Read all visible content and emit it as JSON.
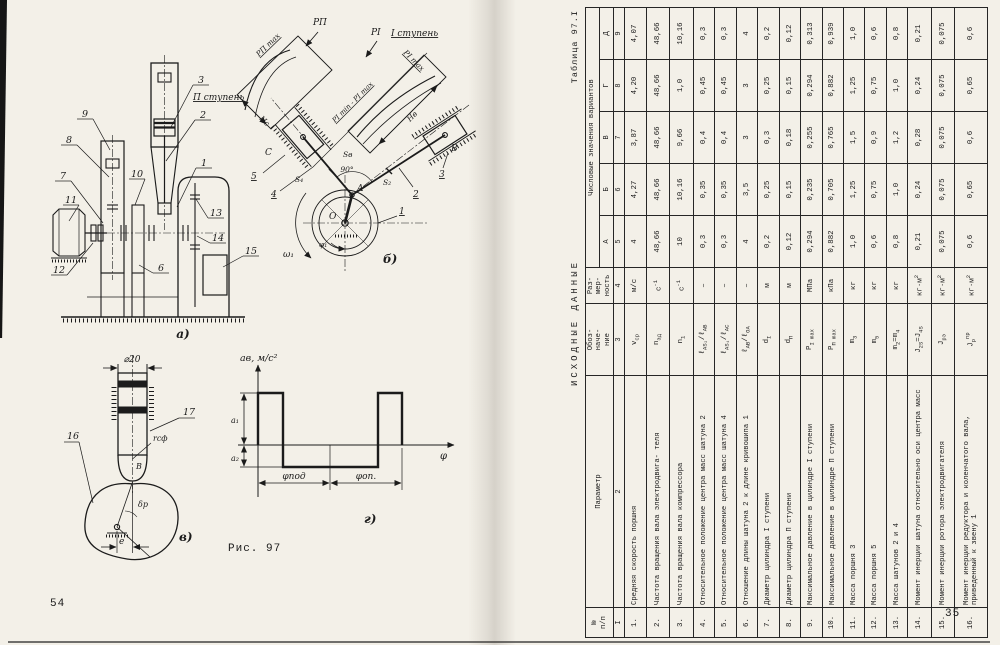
{
  "page_left": {
    "page_number": "54",
    "figure_caption": "Рис. 97",
    "fig_a": {
      "caption": "а)",
      "part_labels": {
        "n1": "1",
        "n2": "2",
        "n3": "3",
        "n6": "6",
        "n7": "7",
        "n8": "8",
        "n9": "9",
        "n10": "10",
        "n11": "11",
        "n12": "12",
        "n13": "13",
        "n14": "14",
        "n15": "15"
      }
    },
    "fig_b": {
      "caption": "б)",
      "stage_left": "П ступень",
      "stage_right": "I ступень",
      "labels": {
        "p2_max": "PП max",
        "p2": "PП",
        "p1": "PI",
        "p1_max": "PI max",
        "p_range": "PI min - PI max",
        "h_c": "Нс",
        "h_b": "Нв",
        "s_b": "Sв",
        "s4": "S₄",
        "s2": "S₂",
        "angle": "90°",
        "omega": "ω₁",
        "phi": "φ₁",
        "point_o": "O",
        "point_a": "A",
        "point_c": "C",
        "point_b": "В",
        "link1": "1",
        "link2": "2",
        "link3": "3",
        "link4": "4",
        "link5": "5"
      }
    },
    "fig_v": {
      "caption": "в)",
      "labels": {
        "dia": "⌀20",
        "r_sf": "rсф",
        "point_b": "В",
        "delta": "δр",
        "ecc": "e",
        "cam": "16",
        "follower": "17"
      }
    },
    "fig_g": {
      "caption": "г)",
      "labels": {
        "ylabel": "ав, м/с²",
        "a1": "а₁",
        "a2": "а₂",
        "xlabel": "φ",
        "phi_up": "φпод",
        "phi_down": "φоп."
      }
    }
  },
  "page_right": {
    "page_number": "35",
    "table_caption": "Таблица 97.I",
    "title": "ИСХОДНЫЕ ДАННЫЕ",
    "table": {
      "header": {
        "num": "№<br>п/п",
        "param": "Параметр",
        "symbol": "Обоз-<br>наче-<br>ние",
        "unit": "Раз-<br>мер-<br>ность",
        "values_group": "Числовые значения вариантов",
        "variants": [
          "А",
          "Б",
          "В",
          "Г",
          "Д"
        ]
      },
      "col_numbers": [
        "I",
        "2",
        "3",
        "4",
        "5",
        "6",
        "7",
        "8",
        "9"
      ],
      "rows": [
        {
          "num": "1.",
          "param": "Средняя скорость поршня",
          "symbol": "v<sub>ср</sub>",
          "unit": "м/с",
          "values": [
            "4",
            "4,27",
            "3,87",
            "4,20",
            "4,07"
          ]
        },
        {
          "num": "2.",
          "param": "Частота вращения вала электродвига- теля",
          "symbol": "n<sub>эд</sub>",
          "unit": "с<sup>-1</sup>",
          "values": [
            "48,66",
            "48,66",
            "48,66",
            "48,66",
            "48,66"
          ]
        },
        {
          "num": "3.",
          "param": "Частота вращения вала компрессора",
          "symbol": "n<sub>1</sub>",
          "unit": "с<sup>-1</sup>",
          "values": [
            "10",
            "10,16",
            "9,66",
            "1,0",
            "10,16"
          ]
        },
        {
          "num": "4.",
          "param": "Относительное положение центра масс шатуна 2",
          "symbol": "ℓ<sub>AS₂</sub>/ℓ<sub>AB</sub>",
          "unit": "–",
          "values": [
            "0,3",
            "0,35",
            "0,4",
            "0,45",
            "0,3"
          ]
        },
        {
          "num": "5.",
          "param": "Относительное положение центра масс шатуна 4",
          "symbol": "ℓ<sub>AS₄</sub>/ℓ<sub>AC</sub>",
          "unit": "–",
          "values": [
            "0,3",
            "0,35",
            "0,4",
            "0,45",
            "0,3"
          ]
        },
        {
          "num": "6.",
          "param": "Отношение длины шатуна 2 к длине кривошипа 1",
          "symbol": "ℓ<sub>AB</sub>/ℓ<sub>OA</sub>",
          "unit": "–",
          "values": [
            "4",
            "3,5",
            "3",
            "3",
            "4"
          ]
        },
        {
          "num": "7.",
          "param": "Диаметр цилиндра I ступени",
          "symbol": "d<sub>I</sub>",
          "unit": "м",
          "values": [
            "0,2",
            "0,25",
            "0,3",
            "0,25",
            "0,2"
          ]
        },
        {
          "num": "8.",
          "param": "Диаметр цилиндра П ступени",
          "symbol": "d<sub>П</sub>",
          "unit": "м",
          "values": [
            "0,12",
            "0,15",
            "0,18",
            "0,15",
            "0,12"
          ]
        },
        {
          "num": "9.",
          "param": "Максимальное давление в цилиндре I ступени",
          "symbol": "P<sub>I max</sub>",
          "unit": "МПа",
          "values": [
            "0,294",
            "0,235",
            "0,255",
            "0,294",
            "0,313"
          ]
        },
        {
          "num": "10.",
          "param": "Максимальное давление в цилиндре П ступени",
          "symbol": "P<sub>П max</sub>",
          "unit": "кПа",
          "values": [
            "0,882",
            "0,705",
            "0,765",
            "0,882",
            "0,939"
          ]
        },
        {
          "num": "11.",
          "param": "Масса поршня 3",
          "symbol": "m<sub>3</sub>",
          "unit": "кг",
          "values": [
            "1,0",
            "1,25",
            "1,5",
            "1,25",
            "1,0"
          ]
        },
        {
          "num": "12.",
          "param": "Масса поршня 5",
          "symbol": "m<sub>5</sub>",
          "unit": "кг",
          "values": [
            "0,6",
            "0,75",
            "0,9",
            "0,75",
            "0,6"
          ]
        },
        {
          "num": "13.",
          "param": "Масса шатунов 2 и 4",
          "symbol": "m<sub>2</sub>=m<sub>4</sub>",
          "unit": "кг",
          "values": [
            "0,8",
            "1,0",
            "1,2",
            "1,0",
            "0,8"
          ]
        },
        {
          "num": "14.",
          "param": "Момент инерции шатуна относительно оси центра масс",
          "symbol": "J<sub>2S</sub>=J<sub>4S</sub>",
          "unit": "кг·м<sup>2</sup>",
          "values": [
            "0,21",
            "0,24",
            "0,28",
            "0,24",
            "0,21"
          ]
        },
        {
          "num": "15.",
          "param": "Момент инерции ротора электродвигателя",
          "symbol": "J<sub>рэ</sub>",
          "unit": "кг·м<sup>2</sup>",
          "values": [
            "0,075",
            "0,075",
            "0,075",
            "0,075",
            "0,075"
          ]
        },
        {
          "num": "16.",
          "param": "Момент инерции редуктора и коленчатого вала, приведенный к звену 1",
          "symbol": "J<sub>р</sub><sup>пр</sup>",
          "unit": "кг·м<sup>2</sup>",
          "values": [
            "0,6",
            "0,65",
            "0,6",
            "0,65",
            "0,6"
          ]
        }
      ]
    }
  }
}
